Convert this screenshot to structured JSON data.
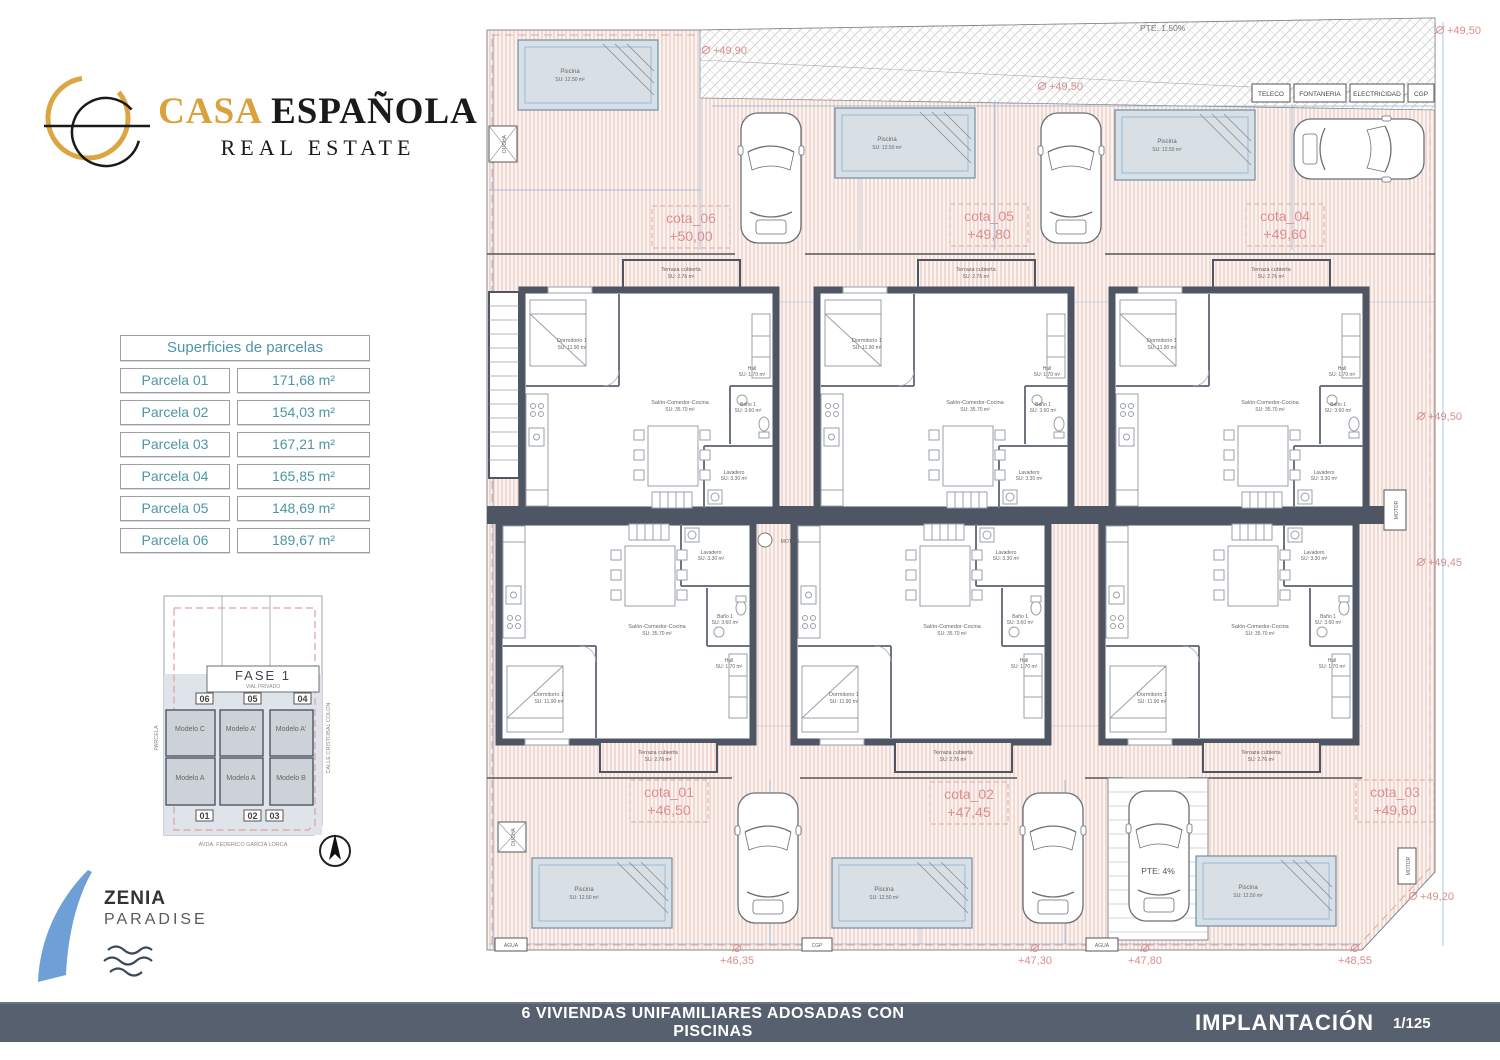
{
  "brand": {
    "word1": "CASA",
    "word2": "ESPAÑOLA",
    "tagline": "REAL ESTATE"
  },
  "parcels_table": {
    "title": "Superficies de parcelas",
    "rows": [
      {
        "label": "Parcela  01",
        "area": "171,68 m²"
      },
      {
        "label": "Parcela  02",
        "area": "154,03 m²"
      },
      {
        "label": "Parcela  03",
        "area": "167,21 m²"
      },
      {
        "label": "Parcela  04",
        "area": "165,85 m²"
      },
      {
        "label": "Parcela  05",
        "area": "148,69 m²"
      },
      {
        "label": "Parcela  06",
        "area": "189,67 m²"
      }
    ]
  },
  "key_plan": {
    "title": "FASE 1",
    "subtitle": "VIAL PRIVADO",
    "parcels_top": [
      "06",
      "05",
      "04"
    ],
    "parcels_bottom": [
      "01",
      "02",
      "03"
    ],
    "models_top": [
      "Modelo C",
      "Modelo A'",
      "Modelo A'"
    ],
    "models_bottom": [
      "Modelo A",
      "Modelo A",
      "Modelo B"
    ],
    "street_left": "PARCELA",
    "street_right": "CALLE CRISTOBAL COLON",
    "street_bottom": "AVDA. FEDERICO GARCÍA LORCA"
  },
  "zenia": {
    "name": "ZENIA",
    "subtitle": "PARADISE"
  },
  "plan": {
    "slope_top": "PTE. 1.50%",
    "slope_ramp": "PTE: 4%",
    "utilities": [
      "TELECO",
      "FONTANERIA",
      "ELECTRICIDAD",
      "CGP"
    ],
    "labels": {
      "ducha": "DUCHA",
      "agua": "AGUA",
      "cgp": "CGP",
      "motor": "MOTOR"
    },
    "rooms": {
      "dormitorio": "Dormitorio 1",
      "dormitorio_area": "SU: 11.90 m²",
      "salon": "Salón-Comedor-Cocina",
      "salon_area": "SU: 35.70 m²",
      "terraza": "Terraza cubierta",
      "terraza_area": "SU: 2.76 m²",
      "lavadero": "Lavadero",
      "lavadero_area": "SU: 3.30 m²",
      "bano": "Baño 1",
      "bano_area": "SU: 3.60 m²",
      "hall": "Hall",
      "hall_area": "SU: 1.70 m²",
      "piscina": "Piscina",
      "piscina_area": "SU: 12.50 m²"
    },
    "cotas": [
      {
        "id": "cota_06",
        "level": "+50,00"
      },
      {
        "id": "cota_05",
        "level": "+49,80"
      },
      {
        "id": "cota_04",
        "level": "+49,60"
      },
      {
        "id": "cota_01",
        "level": "+46,50"
      },
      {
        "id": "cota_02",
        "level": "+47,45"
      },
      {
        "id": "cota_03",
        "level": "+49,60"
      }
    ],
    "levels": [
      {
        "value": "+49,90"
      },
      {
        "value": "+49,50"
      },
      {
        "value": "+49,50"
      },
      {
        "value": "+49,50"
      },
      {
        "value": "+49,45"
      },
      {
        "value": "+49,20"
      },
      {
        "value": "+48,55"
      },
      {
        "value": "+47,80"
      },
      {
        "value": "+47,30"
      },
      {
        "value": "+46,35"
      }
    ]
  },
  "footer": {
    "project": "6 VIVIENDAS UNIFAMILIARES ADOSADAS CON PISCINAS",
    "sheet": "IMPLANTACIÓN",
    "scale": "1/125"
  },
  "colors": {
    "accent_gold": "#D9A23C",
    "cota_red": "#DD9090",
    "dim_blue": "#7BADD6",
    "wall_dark": "#4E5664",
    "footer_bar": "#57606E",
    "table_teal": "#4E95A8",
    "pool_fill": "#D8E0E5",
    "zenia_blue": "#6E9FD6"
  }
}
